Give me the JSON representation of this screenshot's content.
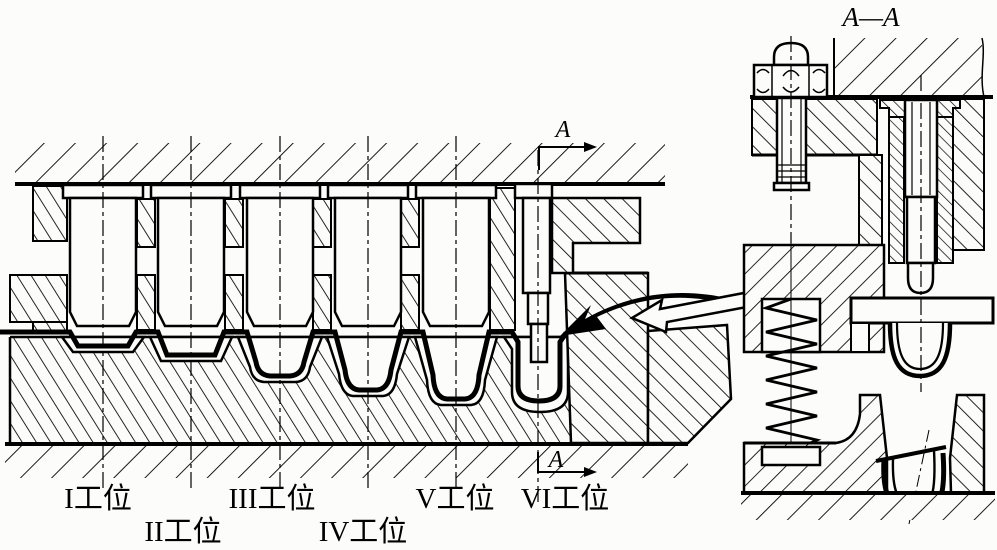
{
  "figure": {
    "kind": "progressive-drawing-die-cross-section",
    "background_color": "#fcfcfa",
    "line_color": "#000000"
  },
  "main_view": {
    "stations": [
      {
        "label": "I工位"
      },
      {
        "label": "II工位"
      },
      {
        "label": "III工位"
      },
      {
        "label": "IV工位"
      },
      {
        "label": "V工位"
      },
      {
        "label": "VI工位"
      }
    ],
    "section_arrows": {
      "top_label": "A",
      "bottom_label": "A"
    }
  },
  "section_view": {
    "title": "A—A"
  }
}
